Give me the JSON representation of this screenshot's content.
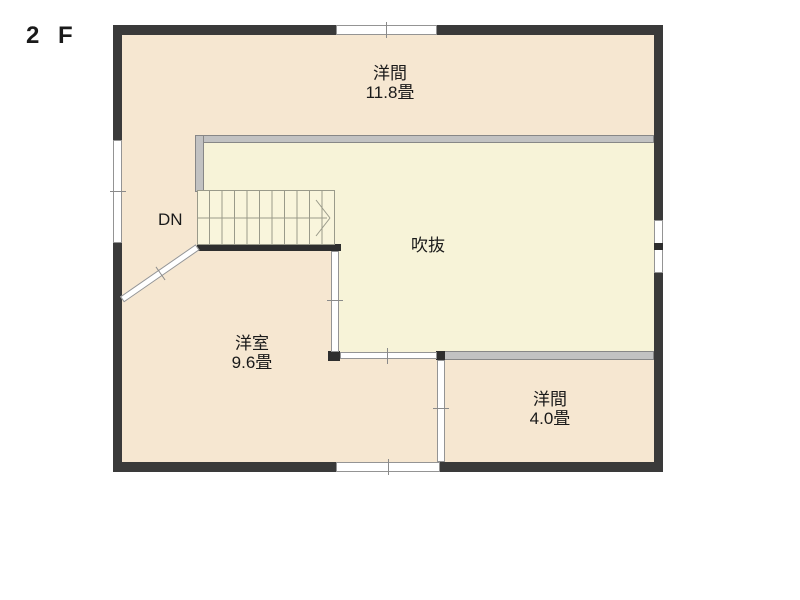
{
  "floor_plan": {
    "floor_label": "2 F",
    "stairs": {
      "direction_label": "DN"
    },
    "rooms": {
      "top": {
        "name": "洋間",
        "size": "11.8畳"
      },
      "void": {
        "name": "吹抜"
      },
      "bottom_left": {
        "name": "洋室",
        "size": "9.6畳"
      },
      "bottom_right": {
        "name": "洋間",
        "size": "4.0畳"
      }
    },
    "colors": {
      "outer_wall": "#3a3a3a",
      "room_fill": "#f6e7d1",
      "void_fill": "#f7f3d8",
      "partition_gray": "#c2c2c2",
      "window_white": "#ffffff"
    }
  }
}
